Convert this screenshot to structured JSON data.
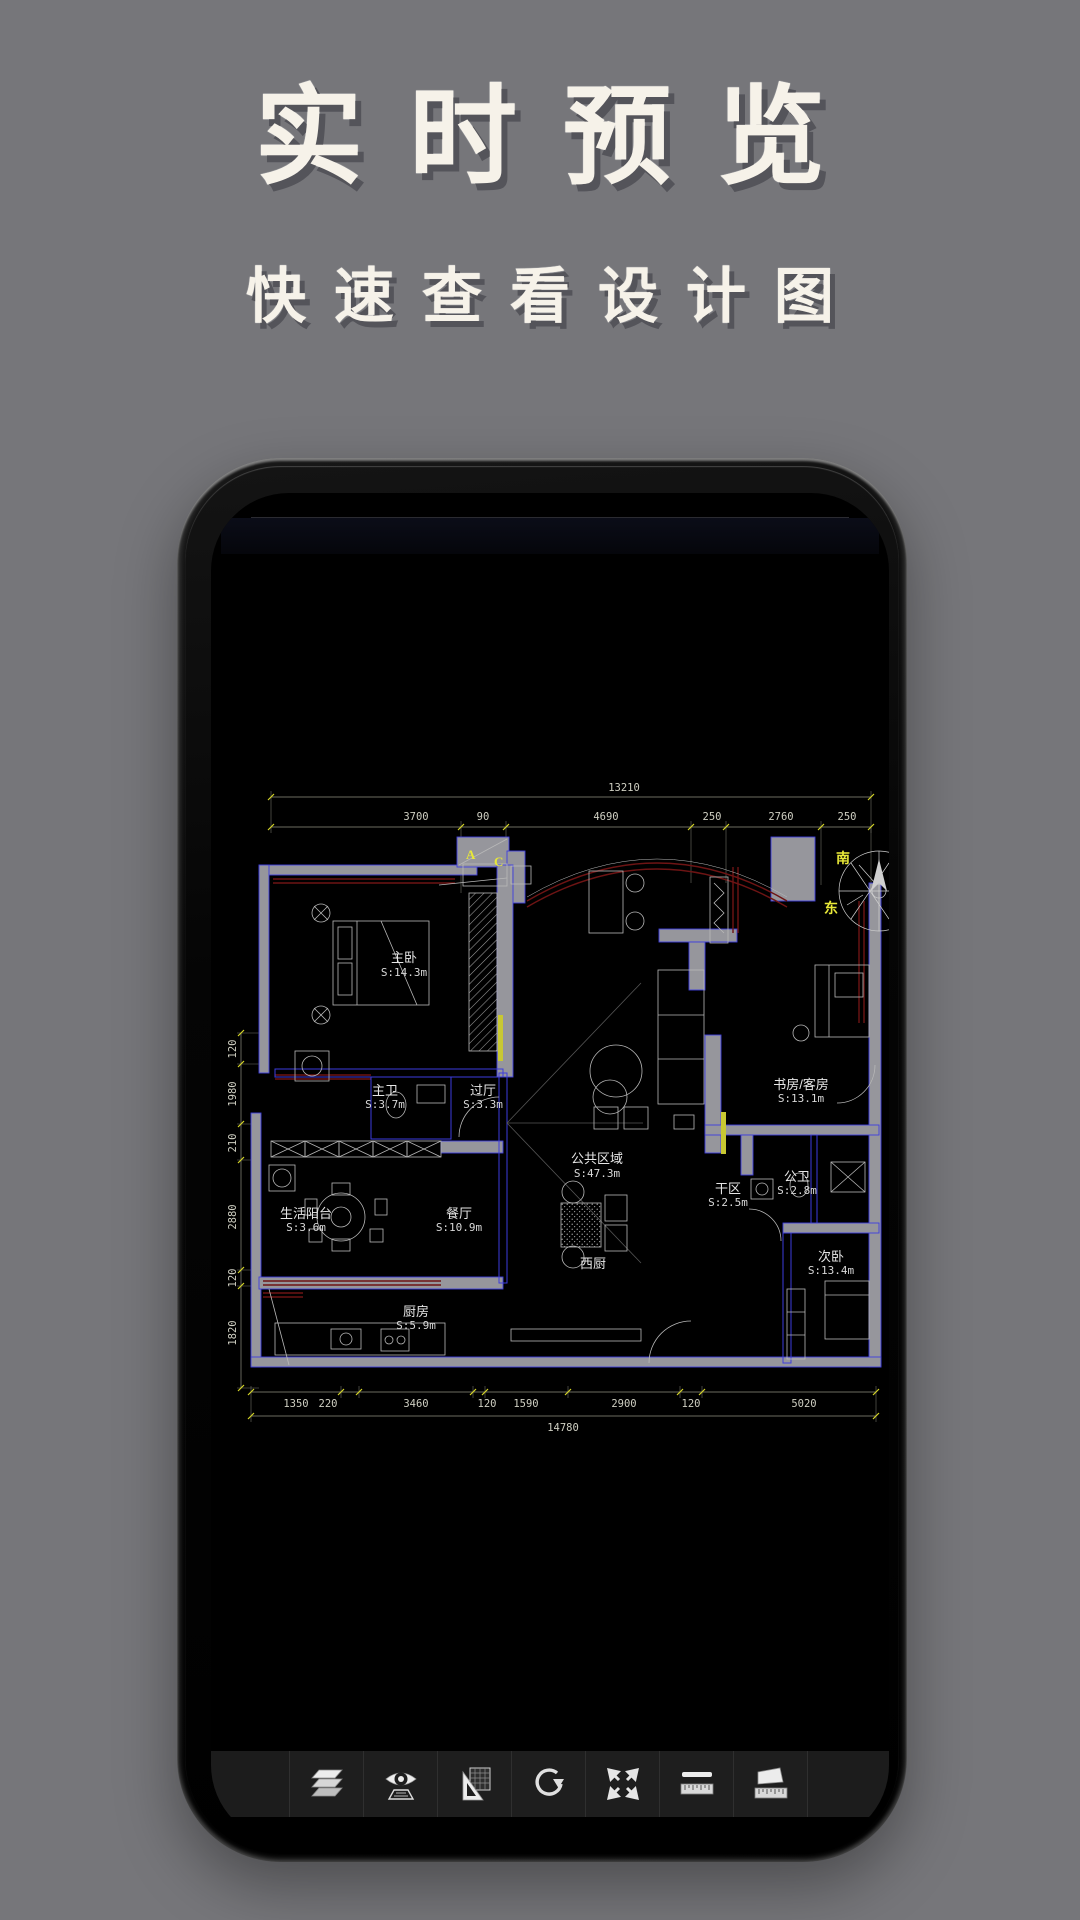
{
  "page": {
    "title": "实时预览",
    "subtitle": "快速查看设计图"
  },
  "plan": {
    "compass": {
      "south": "南",
      "east": "东"
    },
    "markers": {
      "a": "A",
      "c": "C"
    },
    "dims": {
      "top_total": "13210",
      "top": [
        "3700",
        "90",
        "4690",
        "250",
        "2760",
        "250"
      ],
      "left": [
        "120",
        "1980",
        "210",
        "2880",
        "120",
        "1820"
      ],
      "bottom": [
        "1350",
        "220",
        "3460",
        "120",
        "1590",
        "2900",
        "120",
        "5020"
      ],
      "bottom_total": "14780"
    },
    "rooms": [
      {
        "name": "主卧",
        "area": "S:14.3m"
      },
      {
        "name": "主卫",
        "area": "S:3.7m"
      },
      {
        "name": "过厅",
        "area": "S:3.3m"
      },
      {
        "name": "书房/客房",
        "area": "S:13.1m"
      },
      {
        "name": "公共区域",
        "area": "S:47.3m"
      },
      {
        "name": "干区",
        "area": "S:2.5m"
      },
      {
        "name": "公卫",
        "area": "S:2.8m"
      },
      {
        "name": "生活阳台",
        "area": "S:3.6m"
      },
      {
        "name": "餐厅",
        "area": "S:10.9m"
      },
      {
        "name": "西厨",
        "area": ""
      },
      {
        "name": "厨房",
        "area": "S:5.9m"
      },
      {
        "name": "次卧",
        "area": "S:13.4m"
      }
    ],
    "colors": {
      "wall": "#96969c",
      "wall_edge": "#3d3dde",
      "curtain": "#6e1414",
      "dim_tick": "#d6d628",
      "line": "#b8b8b8"
    }
  },
  "toolbar": {
    "tools": [
      {
        "name": "layers"
      },
      {
        "name": "view-preview"
      },
      {
        "name": "set-square"
      },
      {
        "name": "rotate"
      },
      {
        "name": "fit-expand"
      },
      {
        "name": "measure-distance"
      },
      {
        "name": "measure-area"
      }
    ]
  }
}
